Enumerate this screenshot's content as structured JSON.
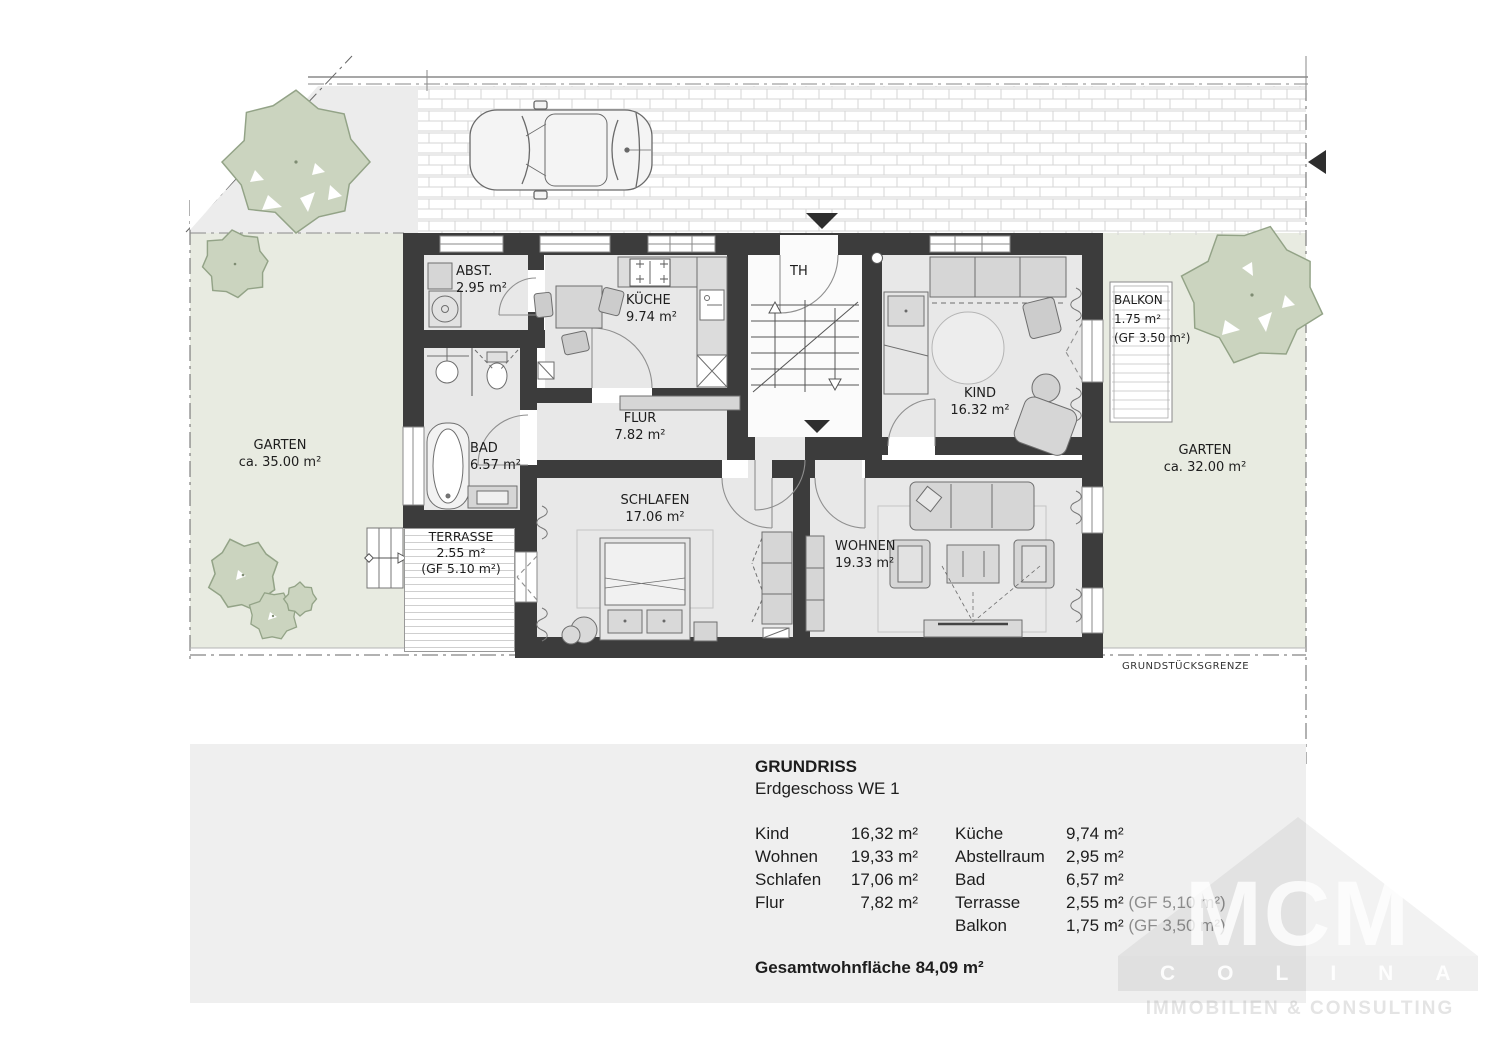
{
  "site": {
    "boundary_label": "GRUNDSTÜCKSGRENZE",
    "garten_left": {
      "name": "GARTEN",
      "area": "ca. 35.00 m²"
    },
    "garten_right": {
      "name": "GARTEN",
      "area": "ca. 32.00 m²"
    }
  },
  "rooms": {
    "abst": {
      "name": "ABST.",
      "area": "2.95 m²"
    },
    "kueche": {
      "name": "KÜCHE",
      "area": "9.74 m²"
    },
    "th": {
      "name": "TH"
    },
    "kind": {
      "name": "KIND",
      "area": "16.32 m²"
    },
    "balkon": {
      "name": "BALKON",
      "area": "1.75 m²",
      "gf": "(GF 3.50 m²)"
    },
    "bad": {
      "name": "BAD",
      "area": "6.57 m²"
    },
    "flur": {
      "name": "FLUR",
      "area": "7.82 m²"
    },
    "schlafen": {
      "name": "SCHLAFEN",
      "area": "17.06 m²"
    },
    "wohnen": {
      "name": "WOHNEN",
      "area": "19.33 m²"
    },
    "terrasse": {
      "name": "TERRASSE",
      "area": "2.55 m²",
      "gf": "(GF 5.10 m²)"
    }
  },
  "panel": {
    "title": "GRUNDRISS",
    "subtitle": "Erdgeschoss WE 1",
    "col1": [
      {
        "label": "Kind",
        "value": "16,32 m²"
      },
      {
        "label": "Wohnen",
        "value": "19,33 m²"
      },
      {
        "label": "Schlafen",
        "value": "17,06 m²"
      },
      {
        "label": "Flur",
        "value": "7,82 m²"
      }
    ],
    "col2": [
      {
        "label": "Küche",
        "value": "9,74 m²",
        "gf": ""
      },
      {
        "label": "Abstellraum",
        "value": "2,95 m²",
        "gf": ""
      },
      {
        "label": "Bad",
        "value": "6,57 m²",
        "gf": ""
      },
      {
        "label": "Terrasse",
        "value": "2,55 m²",
        "gf": " (GF 5,10 m²)"
      },
      {
        "label": "Balkon",
        "value": "1,75 m²",
        "gf": " (GF 3,50 m²)"
      }
    ],
    "total": "Gesamtwohnfläche 84,09 m²"
  },
  "watermark": {
    "monogram": "MCM",
    "name": "COLINA",
    "tagline": "IMMOBILIEN & CONSULTING"
  },
  "colors": {
    "wall": "#3c3c3c",
    "floor": "#e8e8e8",
    "garden": "#e8ebe1",
    "gray_area": "#ececec",
    "tree_fill": "#cbd4bf",
    "tree_stroke": "#93a387",
    "panel": "#efefef",
    "furniture": "#d6d6d6",
    "paving_line": "#d6d6d6"
  }
}
